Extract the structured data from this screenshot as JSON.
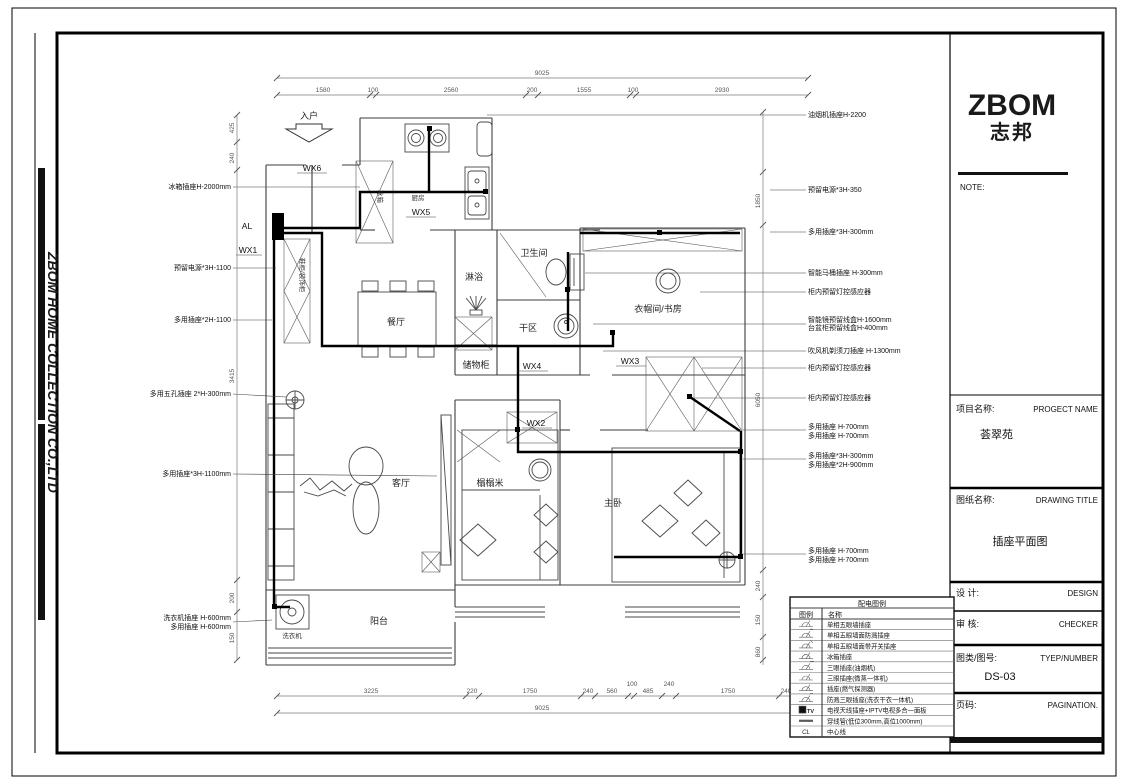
{
  "colors": {
    "line": "#3c3c3c",
    "wire": "#000000",
    "dim": "#555555",
    "paper": "#ffffff"
  },
  "side_strip": {
    "company": "ZBOM HOME COLLECTION CO.,LTD"
  },
  "title_block": {
    "logo1": "ZBOM",
    "logo2": "志邦",
    "note": "NOTE:",
    "project_label": "项目名称:",
    "project_label_en": "PROGECT NAME",
    "project_name": "荟翠苑",
    "drawing_label": "图纸名称:",
    "drawing_label_en": "DRAWING TITLE",
    "drawing_name": "插座平面图",
    "design_label": "设  计:",
    "design_en": "DESIGN",
    "check_label": "审  核:",
    "check_en": "CHECKER",
    "number_label": "图类/图号:",
    "number_en": "TYEP/NUMBER",
    "number_value": "DS-03",
    "page_label": "页码:",
    "page_en": "PAGINATION."
  },
  "plan": {
    "entrance": "入户",
    "al": "AL",
    "wx": {
      "wx1": "WX1",
      "wx2": "WX2",
      "wx3": "WX3",
      "wx4": "WX4",
      "wx5": "WX5",
      "wx6": "WX6"
    },
    "rooms": {
      "kitchen": "厨房",
      "dining": "餐厅",
      "shower": "淋浴",
      "bath": "卫生间",
      "dry": "干区",
      "storage": "储物柜",
      "closet": "衣帽间/书房",
      "living": "客厅",
      "tatami": "榻榻米",
      "master": "主卧",
      "balcony": "阳台",
      "washer": "洗衣机",
      "fridge": "冰箱",
      "shoe": "鞋柜/装饰柜"
    }
  },
  "annotations": {
    "left": [
      "冰箱插座H-2000mm",
      "预留电源*3H-1100",
      "多用插座*2H-1100",
      "多用五孔插座 2*H-300mm",
      "多用插座*3H-1100mm",
      "洗衣机插座 H-600mm",
      "多用插座 H-600mm"
    ],
    "right": [
      "油烟机插座H-2200",
      "预留电源*3H-350",
      "多用插座*3H-300mm",
      "智能马桶插座 H-300mm",
      "柜内预留灯控感应器",
      "智能镜预留线盒H-1600mm",
      "台盆柜预留线盒H-400mm",
      "吹风机剃须刀插座 H-1300mm",
      "柜内预留灯控感应器",
      "柜内预留灯控感应器",
      "多用插座 H-700mm",
      "多用插座 H-700mm",
      "多用插座*3H-300mm",
      "多用插座*2H-900mm",
      "多用插座 H-700mm",
      "多用插座 H-700mm"
    ]
  },
  "dimensions": {
    "top_total": "9025",
    "top_segments": [
      "1580",
      "100",
      "2560",
      "200",
      "1555",
      "100",
      "2930"
    ],
    "bottom_total": "9025",
    "bottom_segments": [
      "3225",
      "220",
      "1750",
      "240",
      "560",
      "100",
      "485",
      "240",
      "1750",
      "240",
      "255"
    ],
    "left": [
      "425",
      "240",
      "3415",
      "200",
      "150"
    ],
    "right_inner": [
      "1850",
      "6050",
      "240",
      "150",
      "860"
    ]
  },
  "legend": {
    "title": "配电图例",
    "col_symbol": "图例",
    "col_name": "名称",
    "rows": [
      {
        "symbol": "five-hole-wall-socket-icon",
        "name": "单相五眼墙插座"
      },
      {
        "symbol": "five-hole-splash-socket-icon",
        "name": "单相五眼墙面防溅插座"
      },
      {
        "symbol": "five-hole-switch-socket-icon",
        "name": "单相五眼墙面带开关插座"
      },
      {
        "symbol": "fridge-socket-icon",
        "name": "冰箱插座"
      },
      {
        "symbol": "three-hole-socket-icon",
        "name": "三眼插座(油烟机)"
      },
      {
        "symbol": "three-hole-socket-icon",
        "name": "三眼插座(微蒸一体机)"
      },
      {
        "symbol": "socket-icon",
        "name": "插座(燃气探测器)"
      },
      {
        "symbol": "splash-three-hole-socket-icon",
        "name": "防溅三眼插座(洗衣干衣一体机)"
      },
      {
        "symbol": "tv-iptv-panel-icon",
        "symbol_text": "TV",
        "name": "电视天线插座+IPTV电视多合一面板"
      },
      {
        "symbol": "conduit-icon",
        "name": "穿线管(低位300mm,高位1000mm)"
      },
      {
        "symbol": "centerline-icon",
        "symbol_text": "CL",
        "name": "中心线"
      }
    ]
  }
}
